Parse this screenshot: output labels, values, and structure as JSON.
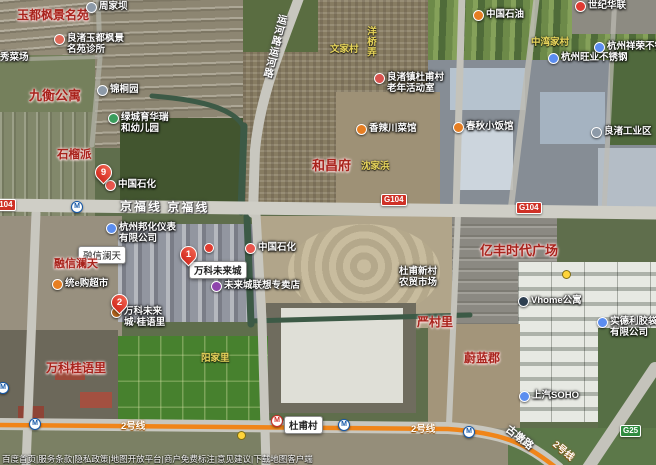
{
  "map": {
    "attribution": "百度首页|服务条款|隐私政策|地图开放平台|商户免费标注|意见建议|下载地图客户端",
    "metro_glyph": "M",
    "colors": {
      "g104_badge": "#cf3126",
      "g25_badge": "#2e8b3f",
      "metro_line2": "#f08519",
      "red_area_label": "#a8231c",
      "yellow_village_label": "#e9d65c"
    },
    "labels": [
      {
        "name": "label-yudufengjing",
        "type": "red",
        "text": "玉都枫景名苑",
        "x": 17,
        "y": 6,
        "fs": 12
      },
      {
        "name": "poi-zhoujiaba",
        "type": "poi",
        "text": "周家坝",
        "icon": "#8d9aa8",
        "icon_name": "village-poi-icon",
        "x": 86,
        "y": 1
      },
      {
        "name": "poi-clinic",
        "type": "poi2",
        "lines": [
          "良渚玉都枫景",
          "名苑诊所"
        ],
        "icon": "#e06a5a",
        "icon_name": "clinic-icon",
        "x": 54,
        "y": 33
      },
      {
        "name": "poi-market-partial",
        "type": "poi",
        "text": "秀菜场",
        "icon": "#8d9aa8",
        "icon_name": "market-icon",
        "x": -13,
        "y": 52
      },
      {
        "name": "label-jiuheng",
        "type": "red",
        "text": "九衡公寓",
        "x": 29,
        "y": 85,
        "fs": 13
      },
      {
        "name": "poi-jintongyuan",
        "type": "poi",
        "text": "锦桐园",
        "icon": "#8d9aa8",
        "icon_name": "garden-poi-icon",
        "x": 97,
        "y": 84
      },
      {
        "name": "poi-kindergarten",
        "type": "poi2",
        "lines": [
          "绿城育华瑞",
          "和幼儿园"
        ],
        "icon": "#3a9d5d",
        "icon_name": "kindergarten-icon",
        "x": 108,
        "y": 112
      },
      {
        "name": "label-shiliupai",
        "type": "red",
        "text": "石榴派",
        "x": 57,
        "y": 146,
        "fs": 11.5
      },
      {
        "name": "marker-pin-9",
        "type": "pin",
        "text": "9",
        "x": 95,
        "y": 164
      },
      {
        "name": "poi-sinopec-west",
        "type": "poi",
        "text": "中国石化",
        "icon": "#e8554d",
        "icon_name": "gas-station-icon",
        "x": 105,
        "y": 179
      },
      {
        "name": "road-label-yunhelu",
        "type": "roadname",
        "text": "运河路运河路",
        "x": 266,
        "y": 13,
        "fs": 10,
        "vertical": true,
        "rot": 14
      },
      {
        "name": "label-wenjiacun",
        "type": "yellow",
        "text": "文家村",
        "x": 330,
        "y": 41
      },
      {
        "name": "label-yangqiaolong",
        "type": "yellow",
        "text": "洋桥弄",
        "x": 363,
        "y": 26,
        "vertical": true
      },
      {
        "name": "poi-senior-center",
        "type": "poi2",
        "lines": [
          "良渚镇杜甫村",
          "老年活动室"
        ],
        "icon": "#d9534f",
        "icon_name": "community-center-icon",
        "x": 374,
        "y": 72
      },
      {
        "name": "poi-petrochina",
        "type": "poi",
        "text": "中国石油",
        "icon": "#e67e22",
        "icon_name": "gas-station-icon",
        "x": 473,
        "y": 9
      },
      {
        "name": "poi-shijihualian",
        "type": "poi",
        "text": "世纪华联",
        "icon": "#df3b33",
        "icon_name": "supermarket-icon",
        "x": 575,
        "y": 0
      },
      {
        "name": "label-zhongwanjiacun",
        "type": "yellow",
        "text": "中湾家村",
        "x": 531,
        "y": 34
      },
      {
        "name": "poi-wangye-steel",
        "type": "poi",
        "text": "杭州旺业不锈钢",
        "icon": "#5b8def",
        "icon_name": "company-icon",
        "x": 548,
        "y": 52
      },
      {
        "name": "poi-xiangrong-steel",
        "type": "poi",
        "text": "杭州祥荣不锈钢",
        "icon": "#5b8def",
        "icon_name": "company-icon",
        "x": 594,
        "y": 41
      },
      {
        "name": "poi-industrial-zone",
        "type": "poi",
        "text": "良渚工业区",
        "icon": "#8d9aa8",
        "icon_name": "industrial-zone-icon",
        "x": 591,
        "y": 126
      },
      {
        "name": "poi-chunqiu-restaurant",
        "type": "poi",
        "text": "春秋小饭馆",
        "icon": "#e67e22",
        "icon_name": "restaurant-icon",
        "x": 453,
        "y": 121
      },
      {
        "name": "poi-xiangla-restaurant",
        "type": "poi",
        "text": "香辣川菜馆",
        "icon": "#e67e22",
        "icon_name": "restaurant-icon",
        "x": 356,
        "y": 123
      },
      {
        "name": "label-hechangfu",
        "type": "red",
        "text": "和昌府",
        "x": 312,
        "y": 155,
        "fs": 13
      },
      {
        "name": "label-shenjiabang",
        "type": "yellow",
        "text": "沈家浜",
        "x": 361,
        "y": 158
      },
      {
        "name": "badge-g104-west",
        "type": "badge-red",
        "text": "G104",
        "x": -10,
        "y": 199
      },
      {
        "name": "metro-logo-1",
        "type": "metro-blue",
        "x": 71,
        "y": 201
      },
      {
        "name": "road-label-jingfuxian",
        "type": "roadname",
        "text": "京福线 京福线",
        "x": 120,
        "y": 198,
        "fs": 12,
        "ls": 2,
        "rot": 1
      },
      {
        "name": "badge-g104-mid",
        "type": "badge-red",
        "text": "G104",
        "x": 381,
        "y": 194
      },
      {
        "name": "badge-g104-east",
        "type": "badge-red",
        "text": "G104",
        "x": 516,
        "y": 202
      },
      {
        "name": "poi-banghua-company",
        "type": "poi2",
        "lines": [
          "杭州邦化仪表",
          "有限公司"
        ],
        "icon": "#5b8def",
        "icon_name": "company-icon",
        "x": 106,
        "y": 222
      },
      {
        "name": "label-rongxin-box",
        "type": "box",
        "text": "融信澜天",
        "x": 78,
        "y": 246
      },
      {
        "name": "label-rongxin-red",
        "type": "red",
        "text": "融信澜天",
        "x": 54,
        "y": 255,
        "fs": 11
      },
      {
        "name": "poi-tonge-market",
        "type": "poi",
        "text": "统e购超市",
        "icon": "#e67e22",
        "icon_name": "supermarket-icon",
        "x": 52,
        "y": 278
      },
      {
        "name": "marker-pin-1",
        "type": "pin",
        "text": "1",
        "x": 180,
        "y": 246
      },
      {
        "name": "label-wanke-box",
        "type": "box",
        "text": "万科未来城",
        "x": 189,
        "y": 261,
        "bold": true
      },
      {
        "name": "marker-dot-red",
        "type": "dot-red",
        "x": 204,
        "y": 243
      },
      {
        "name": "poi-sinopec-east",
        "type": "poi",
        "text": "中国石化",
        "icon": "#e8554d",
        "icon_name": "gas-station-icon",
        "x": 245,
        "y": 242
      },
      {
        "name": "poi-lenovo-store",
        "type": "poi",
        "text": "未来城联想专卖店",
        "icon": "#8e44ad",
        "icon_name": "electronics-store-icon",
        "x": 211,
        "y": 280
      },
      {
        "name": "marker-pin-2",
        "type": "pin",
        "text": "2",
        "x": 111,
        "y": 294
      },
      {
        "name": "poi-guiyuli",
        "type": "poi2",
        "lines": [
          "万科未来",
          "城·桂语里"
        ],
        "icon": "#b5651d",
        "icon_name": "residence-icon",
        "x": 111,
        "y": 306
      },
      {
        "name": "label-wanke-guiyuli",
        "type": "red",
        "text": "万科桂语里",
        "x": 46,
        "y": 359,
        "fs": 12
      },
      {
        "name": "label-yangjiali",
        "type": "yellow",
        "text": "阳家里",
        "x": 201,
        "y": 350
      },
      {
        "name": "label-yifeng-plaza",
        "type": "red",
        "text": "亿丰时代广场",
        "x": 480,
        "y": 240,
        "fs": 13
      },
      {
        "name": "poi-nongmao-market",
        "type": "white2",
        "lines": [
          "杜甫新村",
          "农贸市场"
        ],
        "x": 399,
        "y": 266
      },
      {
        "name": "label-yancunli",
        "type": "red",
        "text": "严村里",
        "x": 417,
        "y": 313,
        "fs": 12
      },
      {
        "name": "label-weilanjun",
        "type": "red",
        "text": "蔚蓝郡",
        "x": 464,
        "y": 349,
        "fs": 12
      },
      {
        "name": "poi-vhome",
        "type": "poi",
        "text": "Vhome公寓",
        "icon": "#2c3e50",
        "icon_name": "apartment-icon",
        "x": 518,
        "y": 295
      },
      {
        "name": "marker-dot-yellow-1",
        "type": "dot-yellow",
        "x": 562,
        "y": 270
      },
      {
        "name": "poi-shideli",
        "type": "poi2",
        "lines": [
          "实德利胶袋",
          "有限公司"
        ],
        "icon": "#5b8def",
        "icon_name": "company-icon",
        "x": 597,
        "y": 316
      },
      {
        "name": "poi-soho",
        "type": "poi",
        "text": "上汽SOHO",
        "icon": "#5b8def",
        "icon_name": "office-icon",
        "x": 519,
        "y": 390
      },
      {
        "name": "metro-logo-2",
        "type": "metro-blue",
        "x": -3,
        "y": 382
      },
      {
        "name": "metro-logo-3",
        "type": "metro-blue",
        "x": 29,
        "y": 418
      },
      {
        "name": "road-label-line2-a",
        "type": "roadname-metro",
        "text": "2号线",
        "x": 121,
        "y": 418
      },
      {
        "name": "marker-dot-yellow-2",
        "type": "dot-yellow",
        "x": 237,
        "y": 431
      },
      {
        "name": "metro-station-dufucun",
        "type": "metro-red",
        "x": 271,
        "y": 415
      },
      {
        "name": "label-dufucun",
        "type": "box",
        "text": "杜甫村",
        "x": 284,
        "y": 416,
        "bold": true
      },
      {
        "name": "metro-logo-4",
        "type": "metro-blue",
        "x": 338,
        "y": 419
      },
      {
        "name": "road-label-line2-b",
        "type": "roadname-metro",
        "text": "2号线",
        "x": 411,
        "y": 421
      },
      {
        "name": "metro-logo-5",
        "type": "metro-blue",
        "x": 463,
        "y": 426
      },
      {
        "name": "road-label-gudunlu",
        "type": "roadname",
        "text": "古墩路",
        "x": 504,
        "y": 430,
        "fs": 10.5,
        "rot": 38
      },
      {
        "name": "road-label-line2-c",
        "type": "roadname-metro",
        "text": "2号线",
        "x": 552,
        "y": 443,
        "rot": 40
      },
      {
        "name": "badge-g25",
        "type": "badge-green",
        "text": "G25",
        "x": 620,
        "y": 425
      }
    ]
  }
}
